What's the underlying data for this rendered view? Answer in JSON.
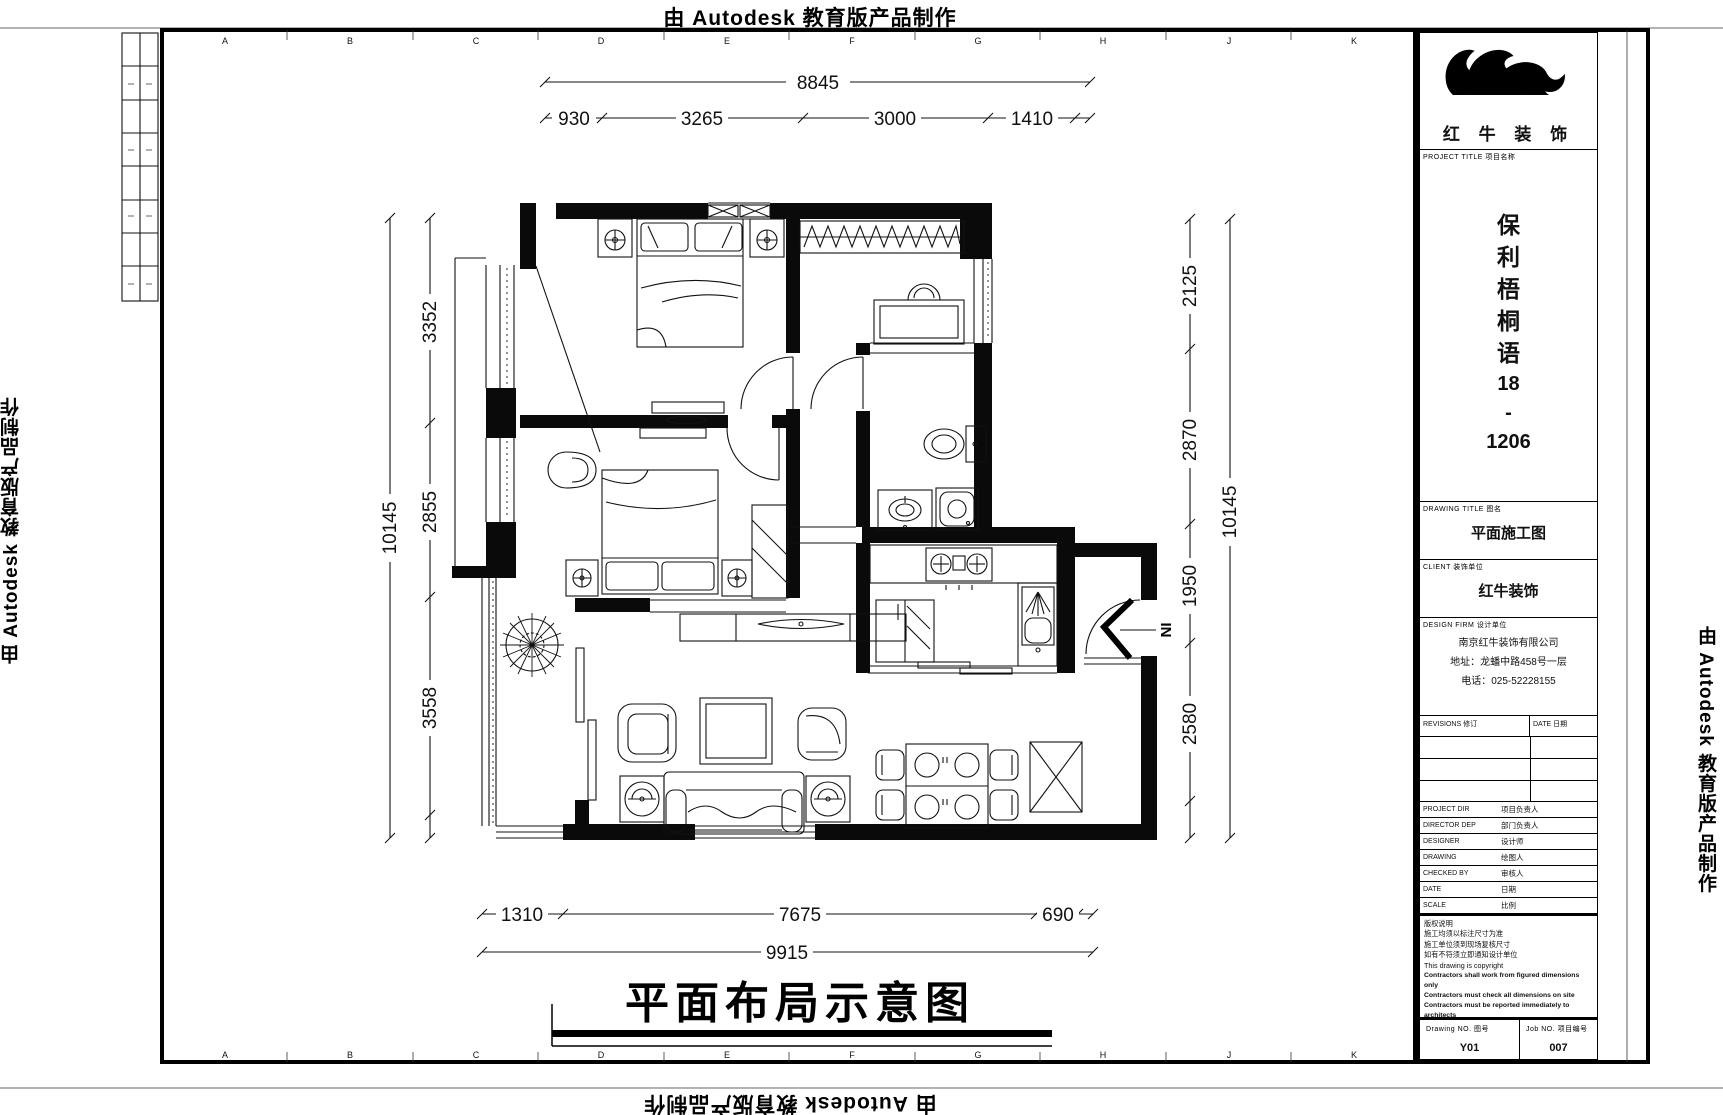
{
  "watermark": {
    "text": "由 Autodesk 教育版产品制作"
  },
  "grid": {
    "letters": [
      "A",
      "B",
      "C",
      "D",
      "E",
      "F",
      "G",
      "H",
      "J",
      "K"
    ]
  },
  "plan": {
    "title": "平面布局示意图",
    "entry_label": "IN"
  },
  "dims": {
    "top": {
      "total": "8845",
      "segments": [
        "930",
        "3265",
        "3000",
        "1410"
      ]
    },
    "left": {
      "total": "10145",
      "segments": [
        "3352",
        "2855",
        "3558"
      ]
    },
    "right": {
      "total": "10145",
      "segments": [
        "2125",
        "2870",
        "1950",
        "2580"
      ]
    },
    "bottom": {
      "total": "9915",
      "row1": [
        "1310",
        "7675",
        "690"
      ]
    }
  },
  "title_block": {
    "logo_text": "红 牛 装 饰",
    "project_title_label": "PROJECT TITLE 项目名称",
    "name_chars": [
      "保",
      "利",
      "梧",
      "桐",
      "语",
      "18",
      "-",
      "1206"
    ],
    "drawing_title_label": "DRAWING TITLE 图名",
    "drawing_title": "平面施工图",
    "client_label": "CLIENT 装饰单位",
    "client": "红牛装饰",
    "design_firm_label": "DESIGN FIRM 设计单位",
    "firm_lines": [
      "南京红牛装饰有限公司",
      "地址：龙蟠中路458号一层",
      "电话：025-52228155"
    ],
    "revisions_label": "REVISIONS 修订",
    "date_col_label": "DATE 日期",
    "rows": [
      {
        "en": "PROJECT DIR",
        "cn": "项目负责人"
      },
      {
        "en": "DIRECTOR DEP",
        "cn": "部门负责人"
      },
      {
        "en": "DESIGNER",
        "cn": "设计师"
      },
      {
        "en": "DRAWING",
        "cn": "绘图人"
      },
      {
        "en": "CHECKED BY",
        "cn": "审核人"
      },
      {
        "en": "DATE",
        "cn": "日期"
      },
      {
        "en": "SCALE",
        "cn": "比例"
      }
    ],
    "notes": [
      "版权说明",
      "施工均须以标注尺寸为准",
      "施工单位须到现场复核尺寸",
      "如有不符须立即通知设计单位",
      "This drawing is copyright",
      "Contractors shall work from figured dimensions only",
      "Contractors must check all dimensions on site",
      "Contractors must be reported immediately to architects"
    ],
    "drawing_no_label": "Drawing NO. 图号",
    "drawing_no": "Y01",
    "job_no_label": "Job NO. 项目编号",
    "job_no": "007"
  }
}
